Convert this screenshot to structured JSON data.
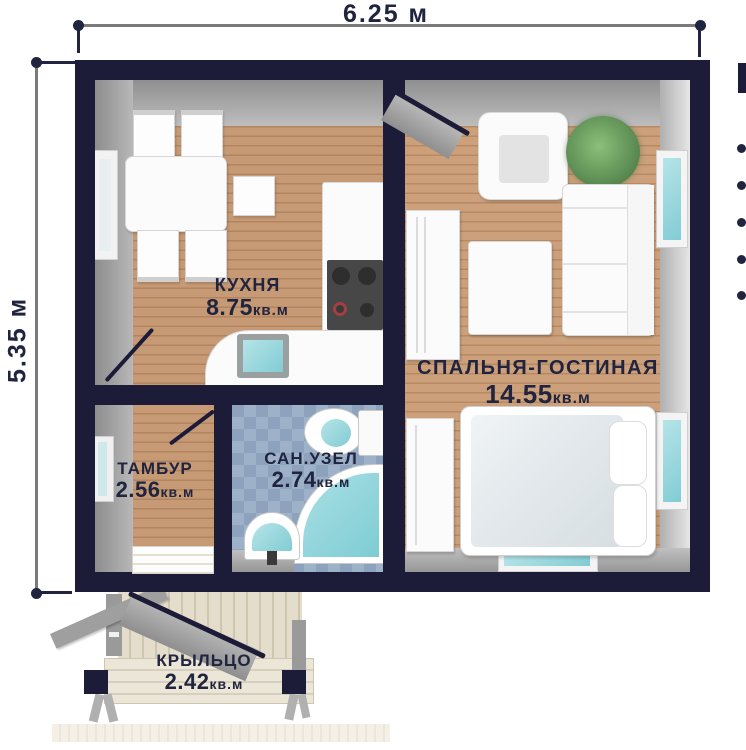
{
  "plan": {
    "dimensions": {
      "width_label": "6.25 м",
      "height_label": "5.35 м"
    },
    "rooms": {
      "kitchen": {
        "name": "КУХНЯ",
        "area": "8.75",
        "unit": "кв.м"
      },
      "living": {
        "name": "СПАЛЬНЯ-ГОСТИНАЯ",
        "area": "14.55",
        "unit": "кв.м"
      },
      "vestibule": {
        "name": "ТАМБУР",
        "area": "2.56",
        "unit": "кв.м"
      },
      "bathroom": {
        "name": "САН.УЗЕЛ",
        "area": "2.74",
        "unit": "кв.м"
      },
      "porch": {
        "name": "КРЫЛЬЦО",
        "area": "2.42",
        "unit": "кв.м"
      }
    }
  },
  "right_edge": {
    "bullet_count": 5
  },
  "colors": {
    "wall": "#1c1c38",
    "label_text": "#20243f",
    "wood_floor": "#c69a74",
    "tile_floor": "#8da2bc",
    "porch_deck": "#e5ddcb",
    "glass_teal": "#8fd2da",
    "wall_face_gray": "#a5a5a5",
    "dimension_line": "#7a7a7a"
  }
}
